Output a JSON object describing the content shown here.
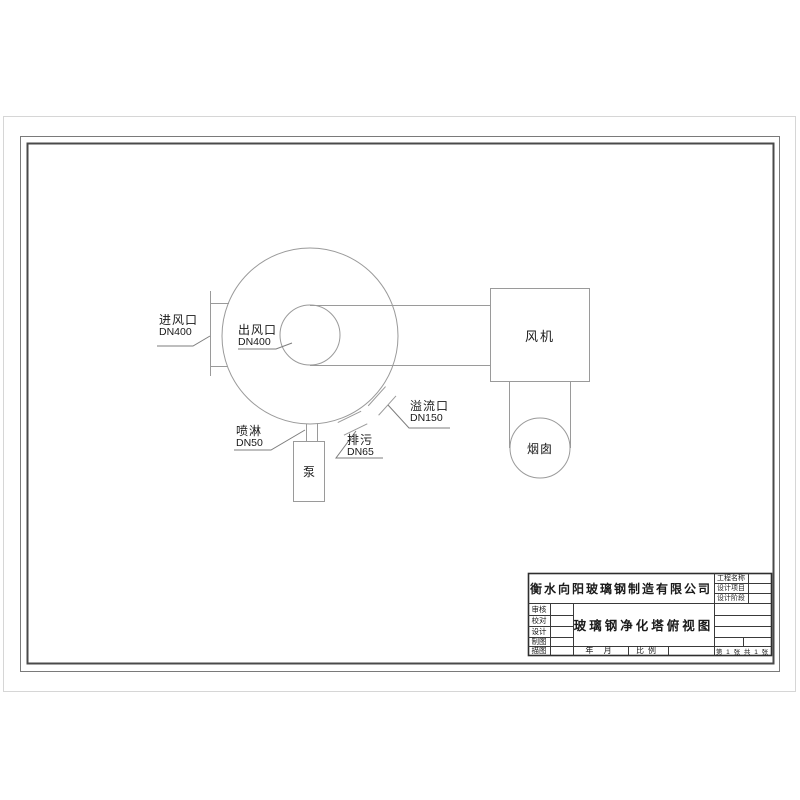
{
  "sheet": {
    "drawing": {
      "inlet_label": "进风口",
      "inlet_size": "DN400",
      "outlet_label": "出风口",
      "outlet_size": "DN400",
      "overflow_label": "溢流口",
      "overflow_size": "DN150",
      "drain_label": "排污",
      "drain_size": "DN65",
      "spray_label": "喷淋",
      "spray_size": "DN50",
      "pump_label": "泵",
      "fan_label": "风机",
      "chimney_label": "烟囱"
    },
    "title_block": {
      "company": "衡水向阳玻璃钢制造有限公司",
      "drawing_title": "玻璃钢净化塔俯视图",
      "project_name_label": "工程名称",
      "design_project_label": "设计项目",
      "design_stage_label": "设计阶段",
      "review_label": "审核",
      "proofread_label": "校对",
      "design_label": "设计",
      "drafting_label": "制图",
      "tracing_label": "描图",
      "date_label": "年 月",
      "scale_label": "比例",
      "sheet_label": "第 1 张 共 1 张"
    },
    "line_color": "#9a9a9a",
    "frame_color": "#4a4a4a"
  }
}
